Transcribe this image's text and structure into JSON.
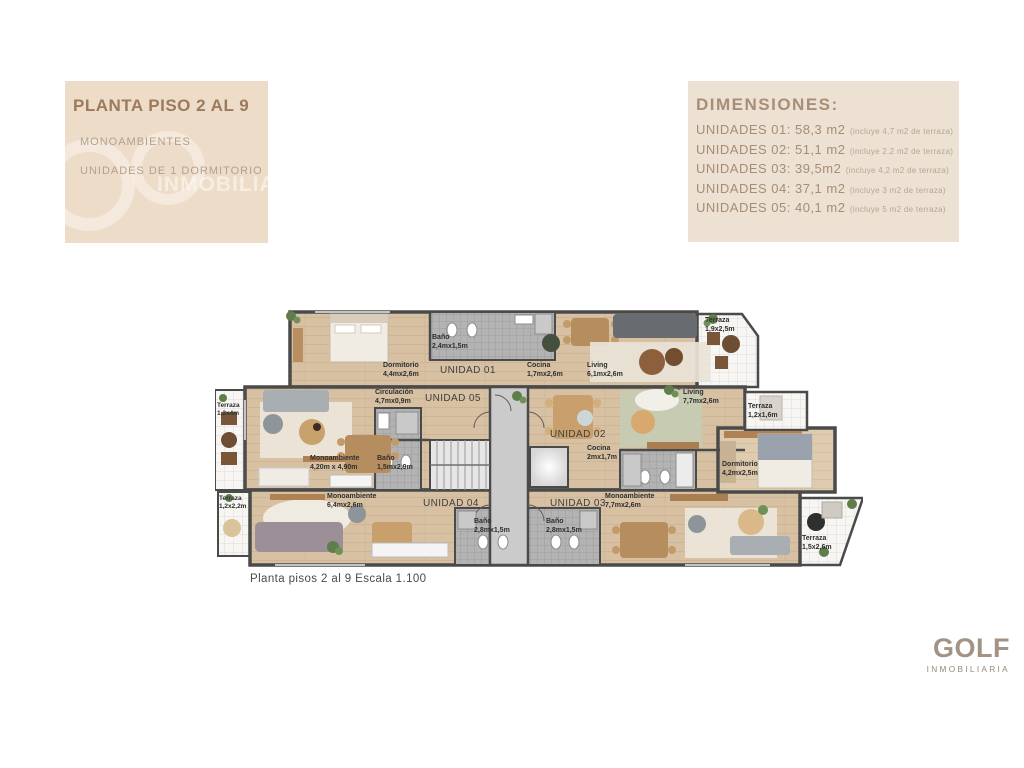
{
  "header": {
    "title": "PLANTA PISO 2 AL 9",
    "subtitle1": "MONOAMBIENTES",
    "subtitle2": "UNIDADES DE 1 DORMITORIO",
    "watermark": "INMOBILIA"
  },
  "dimensions": {
    "heading": "DIMENSIONES:",
    "items": [
      {
        "label": "UNIDADES 01: 58,3 m2",
        "note": "(incluye 4,7 m2 de terraza)"
      },
      {
        "label": "UNIDADES 02: 51,1 m2",
        "note": "(incluye 2.2 m2 de terraza)"
      },
      {
        "label": "UNIDADES 03: 39,5m2",
        "note": "(incluye 4,2 m2 de terraza)"
      },
      {
        "label": "UNIDADES 04: 37,1 m2",
        "note": "(incluye 3 m2 de terraza)"
      },
      {
        "label": "UNIDADES 05: 40,1 m2",
        "note": "(incluye 5 m2 de terraza)"
      }
    ]
  },
  "plan": {
    "caption": "Planta pisos 2 al 9 Escala 1.100",
    "units": {
      "u01": "UNIDAD 01",
      "u02": "UNIDAD 02",
      "u03": "UNIDAD 03",
      "u04": "UNIDAD 04",
      "u05": "UNIDAD 05"
    },
    "rooms": {
      "u01_dorm": {
        "name": "Dormitorio",
        "dims": "4,4mx2,6m"
      },
      "u01_bano": {
        "name": "Baño",
        "dims": "2,4mx1,5m"
      },
      "u01_cocina": {
        "name": "Cocina",
        "dims": "1,7mx2,6m"
      },
      "u01_living": {
        "name": "Living",
        "dims": "6,1mx2,6m"
      },
      "t19": {
        "name": "Terraza",
        "dims": "1,9x2,5m"
      },
      "circ": {
        "name": "Circulación",
        "dims": "4,7mx0,9m"
      },
      "u02_living": {
        "name": "Living",
        "dims": "7,7mx2,6m"
      },
      "t124": {
        "name": "Terraza",
        "dims": "1,2x4m"
      },
      "u05_mono": {
        "name": "Monoambiente",
        "dims": "4,20m x 4,90m"
      },
      "u05_bano": {
        "name": "Baño",
        "dims": "1,5mx2,9m"
      },
      "u02_cocina": {
        "name": "Cocina",
        "dims": "2mx1,7m"
      },
      "t1216": {
        "name": "Terraza",
        "dims": "1,2x1,6m"
      },
      "u02_dorm": {
        "name": "Dormitorio",
        "dims": "4,2mx2,5m"
      },
      "t1222": {
        "name": "Terraza",
        "dims": "1,2x2,2m"
      },
      "u04_mono": {
        "name": "Monoambiente",
        "dims": "6,4mx2,6m"
      },
      "u03_mono": {
        "name": "Monoambiente",
        "dims": "7,7mx2,6m"
      },
      "u04_bano": {
        "name": "Baño",
        "dims": "2,8mx1,5m"
      },
      "u03_bano": {
        "name": "Baño",
        "dims": "2,8mx1,5m"
      },
      "t1526": {
        "name": "Terraza",
        "dims": "1,5x2,6m"
      }
    }
  },
  "logo": {
    "name": "GOLF",
    "tagline": "INMOBILIARIA"
  },
  "colors": {
    "box_left": "#eddcc8",
    "box_right": "#ece1d2",
    "title_brown": "#9b7a5e",
    "text_tan": "#a68d76",
    "wall": "#4a4a4a",
    "wood": "#d7c1a2",
    "tile": "#b3b3b3",
    "terrace": "#f7f6f3",
    "logo_gray": "#a29385"
  }
}
